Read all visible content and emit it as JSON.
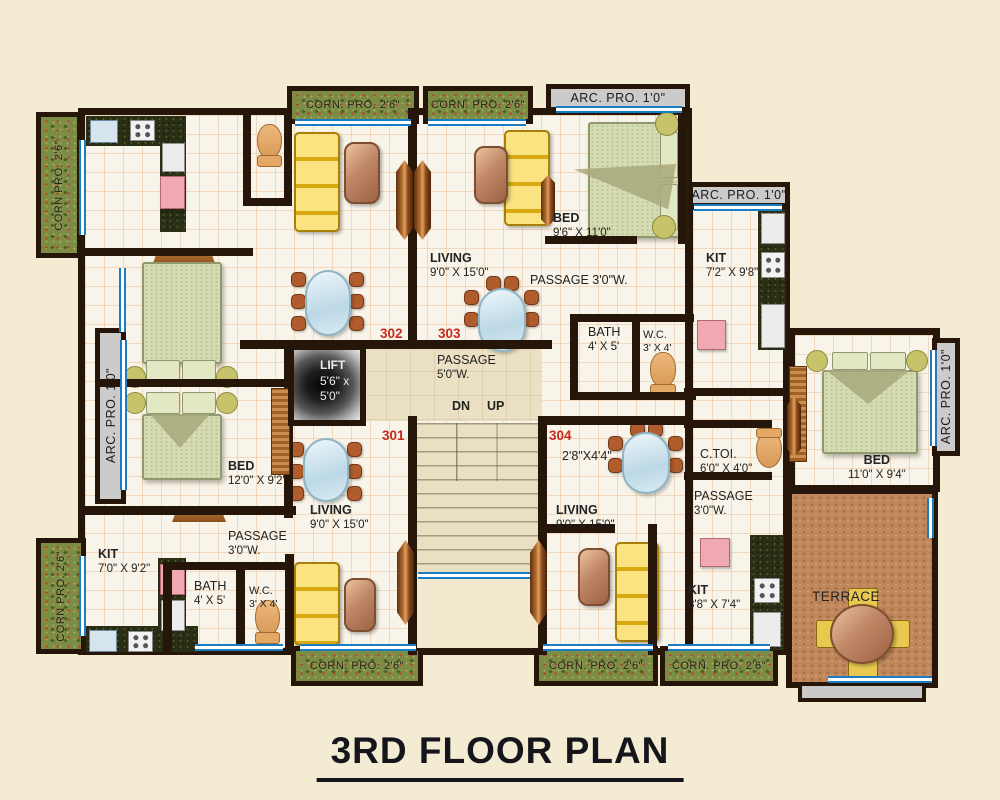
{
  "title": "3RD FLOOR PLAN",
  "palette": {
    "background": "#f4ecd2",
    "wall": "#251609",
    "balcony_green": "#7c8c44",
    "terrace_brick": "#c0875c",
    "window_blue": "#1a7cc2",
    "projection_gray": "#cbcbcb",
    "unit_number_red": "#c52a1e"
  },
  "core": {
    "lift_name": "LIFT",
    "lift_dim1": "5'6\" x",
    "lift_dim2": "5'0\"",
    "passage_name": "PASSAGE",
    "passage_dims": "5'0\"W.",
    "down_label": "DN",
    "up_label": "UP"
  },
  "unit_numbers": {
    "u301": "301",
    "u302": "302",
    "u303": "303",
    "u304": "304"
  },
  "rooms": {
    "bed_303": {
      "name": "BED",
      "dims": "9'6\" X 11'0\""
    },
    "living_303": {
      "name": "LIVING",
      "dims": "9'0\" X 15'0\""
    },
    "kit_303": {
      "name": "KIT",
      "dims": "7'2\" X 9'8\""
    },
    "passage_303": {
      "label": "PASSAGE 3'0\"W."
    },
    "bath_303": {
      "name": "BATH",
      "dims": "4' X 5'"
    },
    "wc_303": {
      "name": "W.C.",
      "dims": "3' X 4'"
    },
    "bed_302": {
      "name": "BED",
      "dims": "12'0\" X 9'2\""
    },
    "kit_301": {
      "name": "KIT",
      "dims": "7'0\" X 9'2\""
    },
    "passage_301": {
      "name": "PASSAGE",
      "dims": "3'0\"W."
    },
    "bath_301": {
      "name": "BATH",
      "dims": "4' X 5'"
    },
    "wc_301": {
      "name": "W.C.",
      "dims": "3' X 4'"
    },
    "living_301": {
      "name": "LIVING",
      "dims": "9'0\" X 15'0\""
    },
    "living_304": {
      "name": "LIVING",
      "dims": "9'0\" X 15'0\""
    },
    "store_304": {
      "dims": "2'8\"X4'4\""
    },
    "ctoi_304": {
      "name": "C.TOI.",
      "dims": "6'0\" X 4'0\""
    },
    "passage_304": {
      "name": "PASSAGE",
      "dims": "3'0\"W."
    },
    "kit_304": {
      "name": "KIT",
      "dims": "8'8\" X 7'4\""
    },
    "bed_304": {
      "name": "BED",
      "dims": "11'0\" X 9'4\""
    },
    "terrace": {
      "name": "TERRACE"
    }
  },
  "projections": {
    "corn_left_top": "CORN PRO. 2'6\"",
    "corn_top_1": "CORN. PRO. 2'6\"",
    "corn_top_2": "CORN. PRO. 2'6\"",
    "arc_top": "ARC. PRO. 1'0\"",
    "arc_top_right": "ARC. PRO. 1'0\"",
    "arc_left": "ARC. PRO. 1'0\"",
    "arc_right": "ARC. PRO. 1'0\"",
    "corn_left_bottom": "CORN PRO. 2'6\"",
    "corn_bottom_1": "CORN. PRO. 2'6\"",
    "corn_bottom_2": "CORN. PRO. 2'6\"",
    "corn_bottom_3": "CORN. PRO. 2'6\""
  }
}
